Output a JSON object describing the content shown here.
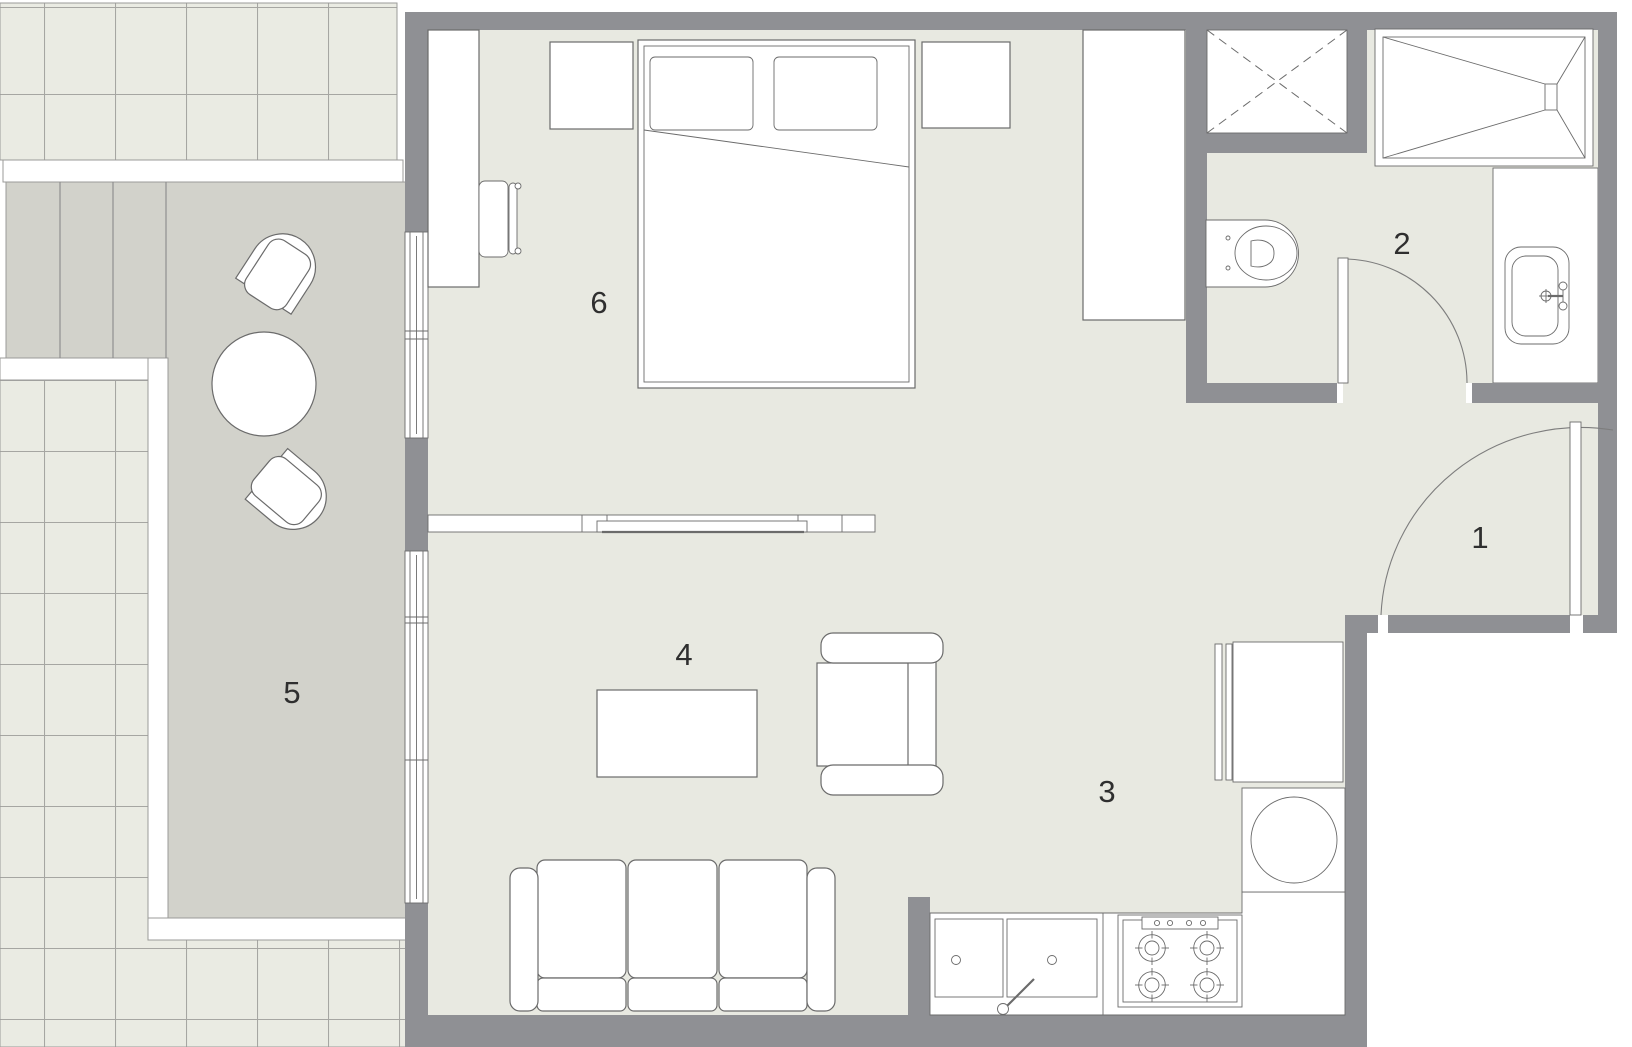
{
  "colors": {
    "wall": "#8f9094",
    "floor": "#e8e9e1",
    "balcony": "#d2d2cb",
    "tile": "#eaebe3",
    "tile-line": "#a6a6a2",
    "line": "#6b6b6b",
    "thin": "#9b9b99",
    "label": "#2f2f2f"
  },
  "rooms": {
    "entrance": {
      "label": "1"
    },
    "bathroom": {
      "label": "2"
    },
    "kitchen": {
      "label": "3"
    },
    "living": {
      "label": "4"
    },
    "balcony": {
      "label": "5"
    },
    "bedroom": {
      "label": "6"
    }
  }
}
